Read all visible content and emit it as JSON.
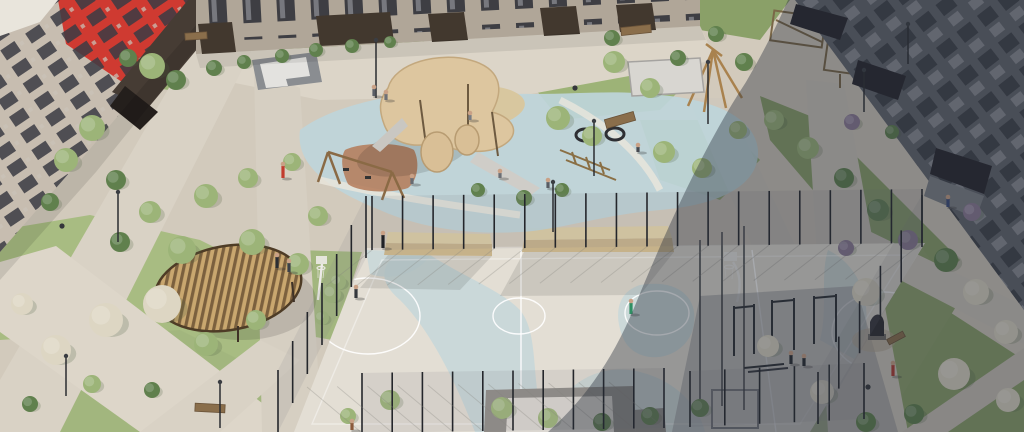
{
  "scene": {
    "kind": "aerial-architectural-render",
    "subject": "residential-courtyard-with-playground-and-sports-court"
  },
  "palette": {
    "paving": "#d2cabc",
    "paving_light": "#dcd5c8",
    "lawn": "#a8bc82",
    "court": "#e3ded4",
    "court_blue": "#c5d7d9",
    "court_line": "#ffffff",
    "play_surface": "#bed5da",
    "sand": "#d8c79f",
    "rubber_red": "#b47a58",
    "canopy": "#ddc69f",
    "wood": "#9c7a4c",
    "bldg_left": "#c7bdb0",
    "bldg_left_light": "#e9e5dc",
    "accent_red": "#cf3a31",
    "bldg_dark_brown": "#463c34",
    "bldg_top": "#b0a698",
    "portico": "#42382e",
    "bldg_right": "#62646c",
    "bleacher_top": "#dccda5",
    "bleacher_front": "#c6b28a",
    "platform": "#908c88",
    "platform_top": "#dcd8d2",
    "fence": "#24262b",
    "mesh": "#7e838a",
    "gazebo_roof": "#c9a76f",
    "gazebo_slat": "#6d5435",
    "pavilion": "#d8d6d1",
    "shadow": "#262c3a",
    "metal_white": "#eceae6",
    "tree_colors": {
      "g": "#9cb478",
      "d": "#60804d",
      "w": "#ddd6c3",
      "p": "#8d7a95"
    }
  },
  "trees": [
    [
      152,
      66,
      13,
      "g"
    ],
    [
      176,
      80,
      10,
      "d"
    ],
    [
      128,
      58,
      9,
      "d"
    ],
    [
      214,
      68,
      8,
      "d"
    ],
    [
      244,
      62,
      7,
      "d"
    ],
    [
      282,
      56,
      7,
      "d"
    ],
    [
      316,
      50,
      7,
      "d"
    ],
    [
      352,
      46,
      7,
      "d"
    ],
    [
      390,
      42,
      6,
      "d"
    ],
    [
      92,
      128,
      13,
      "g"
    ],
    [
      66,
      160,
      12,
      "g"
    ],
    [
      116,
      180,
      10,
      "d"
    ],
    [
      50,
      202,
      9,
      "d"
    ],
    [
      150,
      212,
      11,
      "g"
    ],
    [
      206,
      196,
      12,
      "g"
    ],
    [
      248,
      178,
      10,
      "g"
    ],
    [
      292,
      162,
      9,
      "g"
    ],
    [
      318,
      216,
      10,
      "g"
    ],
    [
      252,
      242,
      13,
      "g"
    ],
    [
      182,
      250,
      14,
      "g"
    ],
    [
      120,
      242,
      10,
      "d"
    ],
    [
      298,
      264,
      11,
      "g"
    ],
    [
      332,
      294,
      9,
      "g"
    ],
    [
      162,
      304,
      19,
      "w"
    ],
    [
      106,
      320,
      17,
      "w"
    ],
    [
      56,
      350,
      15,
      "w"
    ],
    [
      22,
      304,
      11,
      "w"
    ],
    [
      206,
      344,
      12,
      "g"
    ],
    [
      256,
      320,
      10,
      "g"
    ],
    [
      92,
      384,
      9,
      "g"
    ],
    [
      30,
      404,
      8,
      "d"
    ],
    [
      152,
      390,
      8,
      "d"
    ],
    [
      558,
      118,
      12,
      "g"
    ],
    [
      592,
      136,
      10,
      "g"
    ],
    [
      614,
      62,
      11,
      "g"
    ],
    [
      650,
      88,
      10,
      "g"
    ],
    [
      664,
      152,
      11,
      "g"
    ],
    [
      702,
      168,
      10,
      "g"
    ],
    [
      738,
      130,
      9,
      "g"
    ],
    [
      524,
      198,
      8,
      "d"
    ],
    [
      562,
      190,
      7,
      "d"
    ],
    [
      478,
      190,
      7,
      "d"
    ],
    [
      612,
      38,
      8,
      "d"
    ],
    [
      678,
      58,
      8,
      "d"
    ],
    [
      716,
      34,
      8,
      "d"
    ],
    [
      744,
      62,
      9,
      "d"
    ],
    [
      774,
      120,
      10,
      "g"
    ],
    [
      808,
      148,
      11,
      "g"
    ],
    [
      844,
      178,
      10,
      "d"
    ],
    [
      878,
      210,
      11,
      "d"
    ],
    [
      908,
      240,
      10,
      "p"
    ],
    [
      946,
      260,
      12,
      "d"
    ],
    [
      976,
      292,
      13,
      "w"
    ],
    [
      1006,
      332,
      12,
      "w"
    ],
    [
      954,
      374,
      16,
      "w"
    ],
    [
      1008,
      400,
      12,
      "w"
    ],
    [
      914,
      414,
      10,
      "d"
    ],
    [
      852,
      122,
      8,
      "p"
    ],
    [
      892,
      132,
      7,
      "d"
    ],
    [
      972,
      212,
      9,
      "p"
    ],
    [
      846,
      248,
      8,
      "p"
    ],
    [
      390,
      400,
      10,
      "g"
    ],
    [
      348,
      416,
      8,
      "g"
    ],
    [
      502,
      408,
      11,
      "g"
    ],
    [
      548,
      418,
      10,
      "g"
    ],
    [
      602,
      422,
      9,
      "d"
    ],
    [
      650,
      416,
      9,
      "d"
    ],
    [
      700,
      408,
      9,
      "d"
    ],
    [
      866,
      292,
      14,
      "w"
    ],
    [
      768,
      346,
      11,
      "w"
    ],
    [
      822,
      392,
      12,
      "w"
    ],
    [
      866,
      422,
      10,
      "d"
    ],
    [
      338,
      282,
      8,
      "g"
    ],
    [
      322,
      318,
      7,
      "g"
    ]
  ],
  "fence_segments": [
    {
      "x1": 372,
      "y1": 250,
      "x2": 922,
      "y2": 243,
      "n": 19,
      "h": 54,
      "sx": -46,
      "sy": 36
    },
    {
      "x1": 366,
      "y1": 258,
      "x2": 278,
      "y2": 432,
      "n": 7,
      "h": 62
    },
    {
      "x1": 362,
      "y1": 433,
      "x2": 664,
      "y2": 428,
      "n": 11,
      "h": 60,
      "sx": -55,
      "sy": -46
    },
    {
      "x1": 690,
      "y1": 427,
      "x2": 864,
      "y2": 419,
      "n": 6,
      "h": 56
    },
    {
      "x1": 922,
      "y1": 247,
      "x2": 818,
      "y2": 424,
      "n": 6,
      "h": 52
    }
  ],
  "people": [
    [
      283,
      178,
      15,
      "#c23b2e"
    ],
    [
      277,
      268,
      14,
      "#2a2d33"
    ],
    [
      289,
      272,
      12,
      "#3c4048"
    ],
    [
      383,
      248,
      16,
      "#1f2126"
    ],
    [
      356,
      298,
      12,
      "#34373d"
    ],
    [
      631,
      314,
      14,
      "#2f8f63"
    ],
    [
      893,
      376,
      14,
      "#b03a30"
    ],
    [
      791,
      364,
      12,
      "#26282d"
    ],
    [
      804,
      366,
      11,
      "#26282d"
    ],
    [
      948,
      207,
      11,
      "#3a4a7a"
    ],
    [
      374,
      96,
      10,
      "#5a5e66"
    ],
    [
      386,
      100,
      9,
      "#6e7076"
    ],
    [
      412,
      184,
      9,
      "#676b72"
    ],
    [
      548,
      188,
      9,
      "#585c63"
    ],
    [
      638,
      152,
      8,
      "#46494f"
    ],
    [
      352,
      430,
      10,
      "#8a5a3a"
    ],
    [
      470,
      120,
      8,
      "#777c84"
    ],
    [
      500,
      178,
      8,
      "#6a6e75"
    ]
  ],
  "poles": [
    [
      376,
      98,
      58
    ],
    [
      118,
      242,
      50
    ],
    [
      594,
      176,
      55
    ],
    [
      708,
      124,
      62
    ],
    [
      864,
      112,
      42
    ],
    [
      66,
      396,
      40
    ],
    [
      220,
      428,
      46
    ],
    [
      553,
      232,
      50
    ],
    [
      908,
      64,
      40
    ]
  ],
  "benches": [
    [
      636,
      30,
      30,
      8,
      -6
    ],
    [
      620,
      120,
      30,
      9,
      -16
    ],
    [
      210,
      408,
      30,
      8,
      3
    ],
    [
      896,
      338,
      18,
      6,
      -28
    ],
    [
      196,
      36,
      22,
      7,
      -4
    ]
  ],
  "bins": [
    [
      575,
      88
    ],
    [
      868,
      387
    ],
    [
      62,
      226
    ]
  ]
}
